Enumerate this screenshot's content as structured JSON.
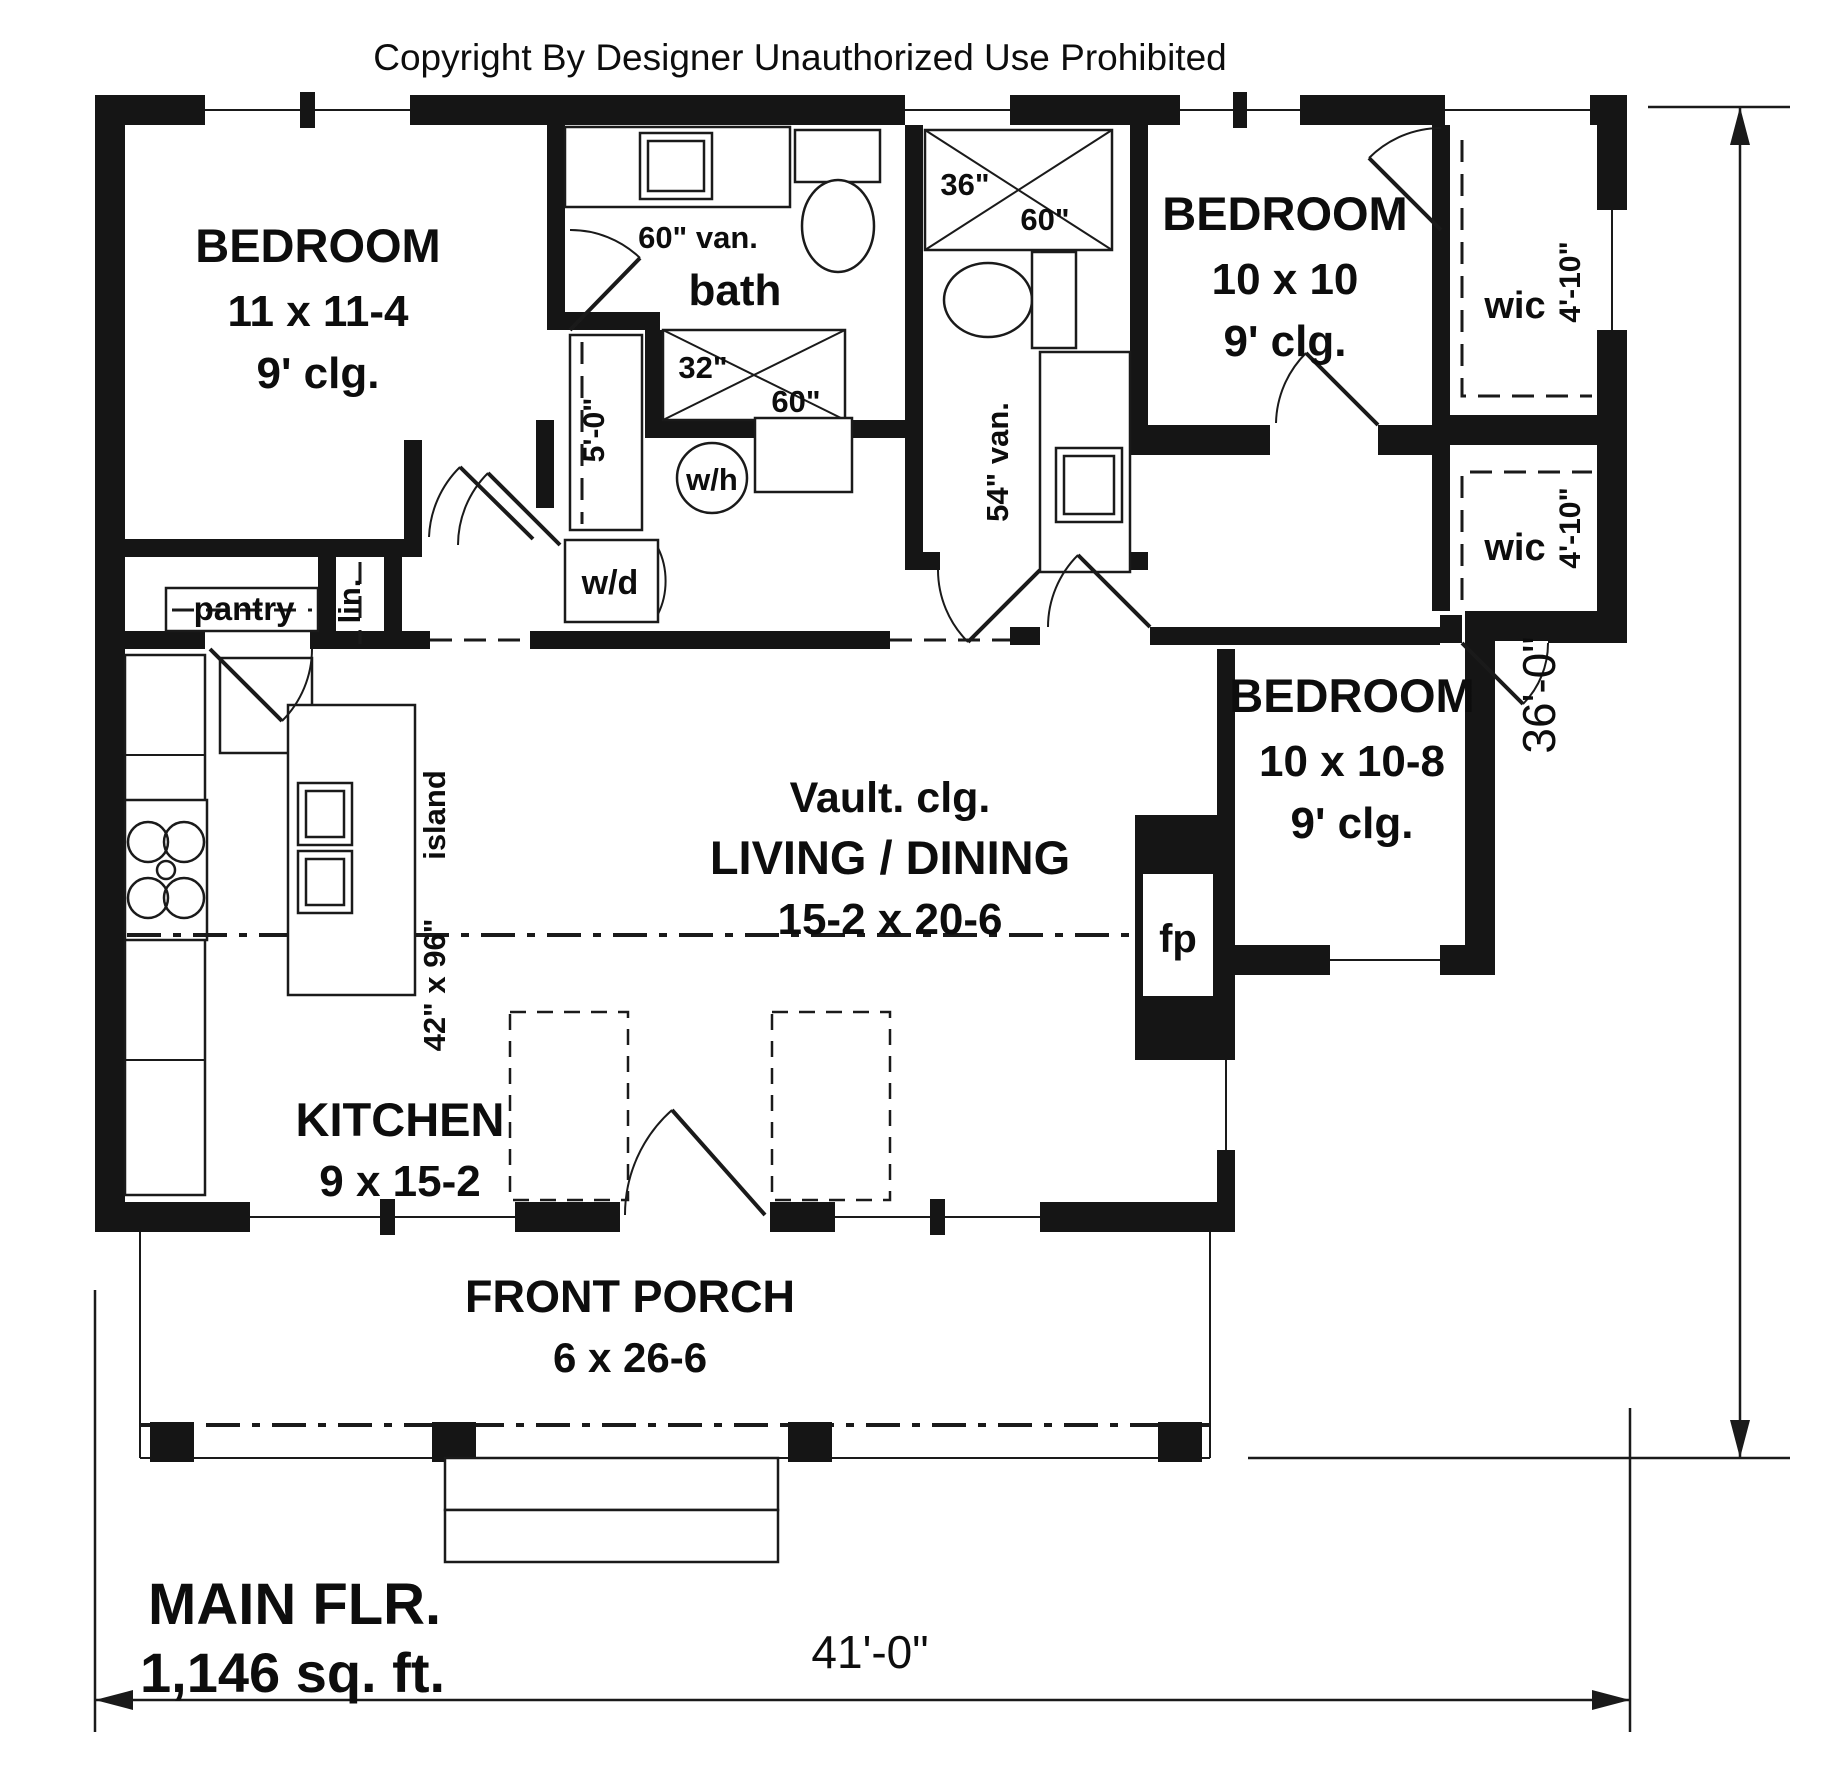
{
  "copyright": "Copyright By Designer Unauthorized Use Prohibited",
  "rooms": {
    "bedroom1": {
      "name": "BEDROOM",
      "dim": "11 x 11-4",
      "ceiling": "9' clg."
    },
    "bedroom2": {
      "name": "BEDROOM",
      "dim": "10 x 10",
      "ceiling": "9' clg."
    },
    "bedroom3": {
      "name": "BEDROOM",
      "dim": "10 x 10-8",
      "ceiling": "9' clg."
    },
    "living": {
      "ceiling": "Vault. clg.",
      "name": "LIVING / DINING",
      "dim": "15-2 x 20-6"
    },
    "kitchen": {
      "name": "KITCHEN",
      "dim": "9 x 15-2"
    },
    "bath": {
      "name": "bath",
      "vanity": "60\" van."
    },
    "bath2": {
      "vanity": "54\" van."
    },
    "porch": {
      "name": "FRONT PORCH",
      "dim": "6 x 26-6"
    },
    "wic1": {
      "name": "wic",
      "dim": "4'-10\""
    },
    "wic2": {
      "name": "wic",
      "dim": "4'-10\""
    },
    "pantry": {
      "name": "pantry"
    },
    "linen": {
      "name": "lin."
    },
    "closet": {
      "dim": "5'-0\""
    },
    "laundry": {
      "washer_dryer": "w/d",
      "water_heater": "w/h"
    },
    "fireplace": {
      "name": "fp"
    },
    "island": {
      "name": "island",
      "dim": "42\" x 96\""
    }
  },
  "showers": {
    "bath1": {
      "depth": "32\"",
      "width": "60\""
    },
    "bath2": {
      "depth": "36\"",
      "width": "60\""
    }
  },
  "dimensions": {
    "width": "41'-0\"",
    "height": "36'-0\""
  },
  "floor_summary": {
    "title": "MAIN FLR.",
    "area": "1,146 sq. ft."
  }
}
